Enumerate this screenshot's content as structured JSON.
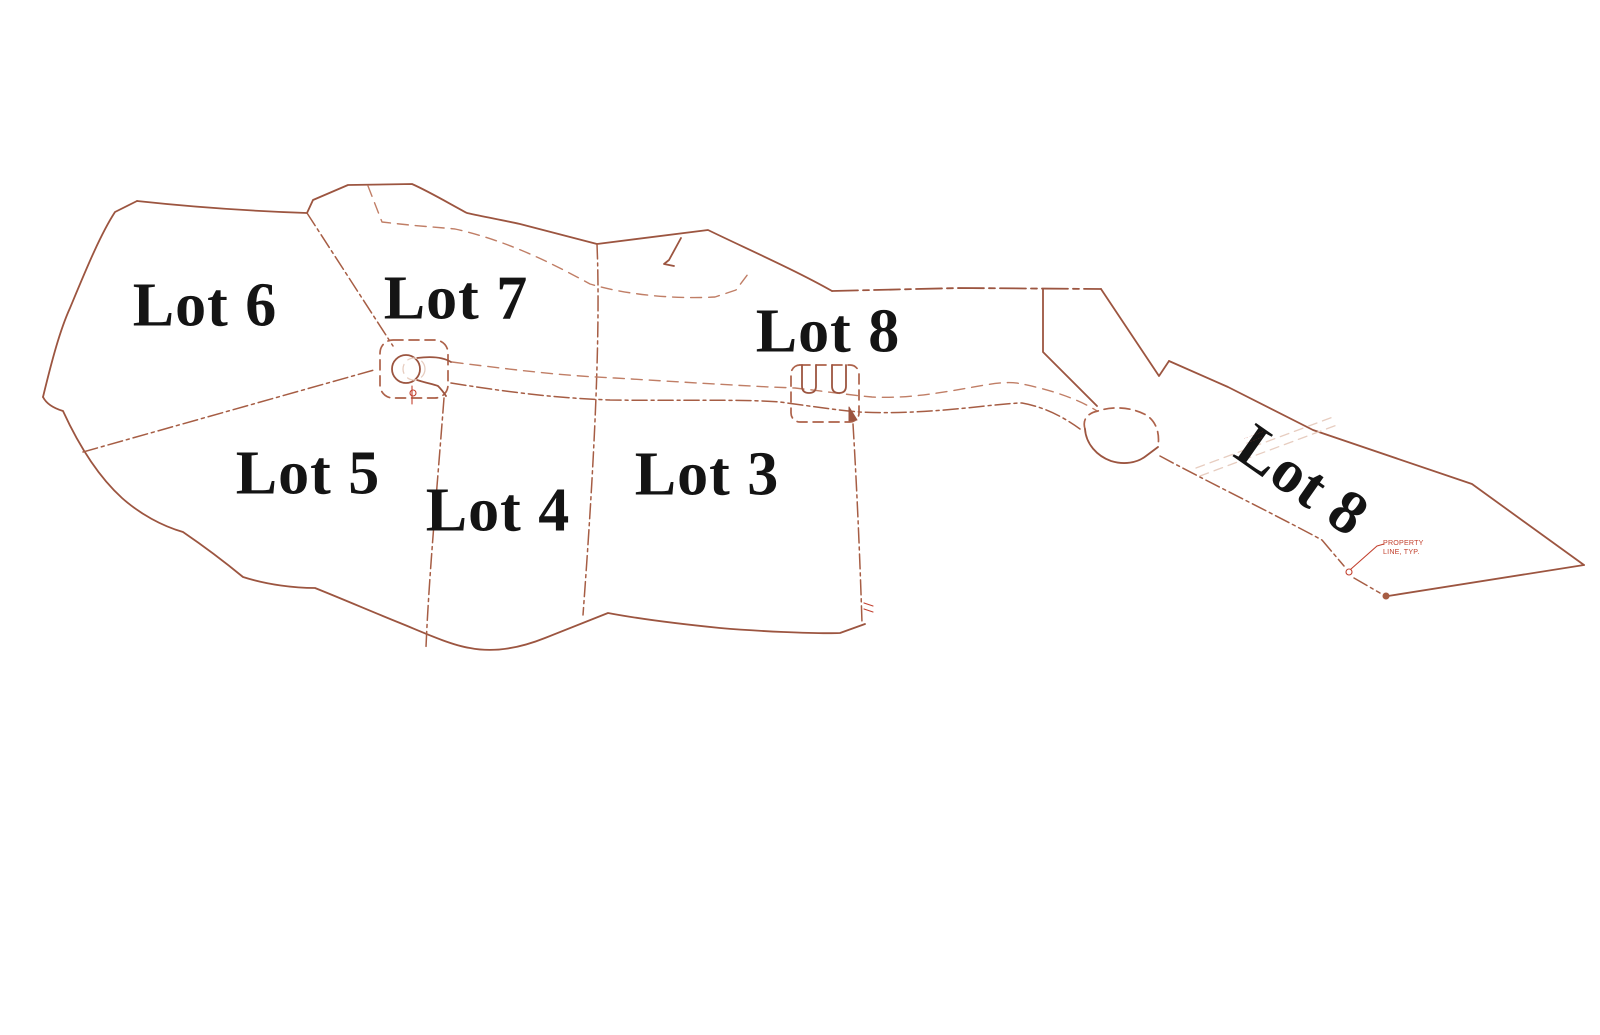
{
  "colors": {
    "line": "#9c5540",
    "divider": "#a65d44",
    "road": "#c07e66",
    "rect-dash": "#ad624a",
    "faint": "#e7cdc0",
    "annotation": "#c2402e",
    "label": "#141414",
    "background": "#ffffff"
  },
  "labels": {
    "lot6": "Lot 6",
    "lot7": "Lot 7",
    "lot8_center": "Lot 8",
    "lot5": "Lot 5",
    "lot4": "Lot 4",
    "lot3": "Lot 3",
    "lot8_east": "Lot 8"
  },
  "annotations": {
    "property_line_1": "PROPERTY",
    "property_line_2": "LINE, TYP.",
    "small_note_1": "··· ···· ·····",
    "small_note_2": "·· ····· ···"
  }
}
